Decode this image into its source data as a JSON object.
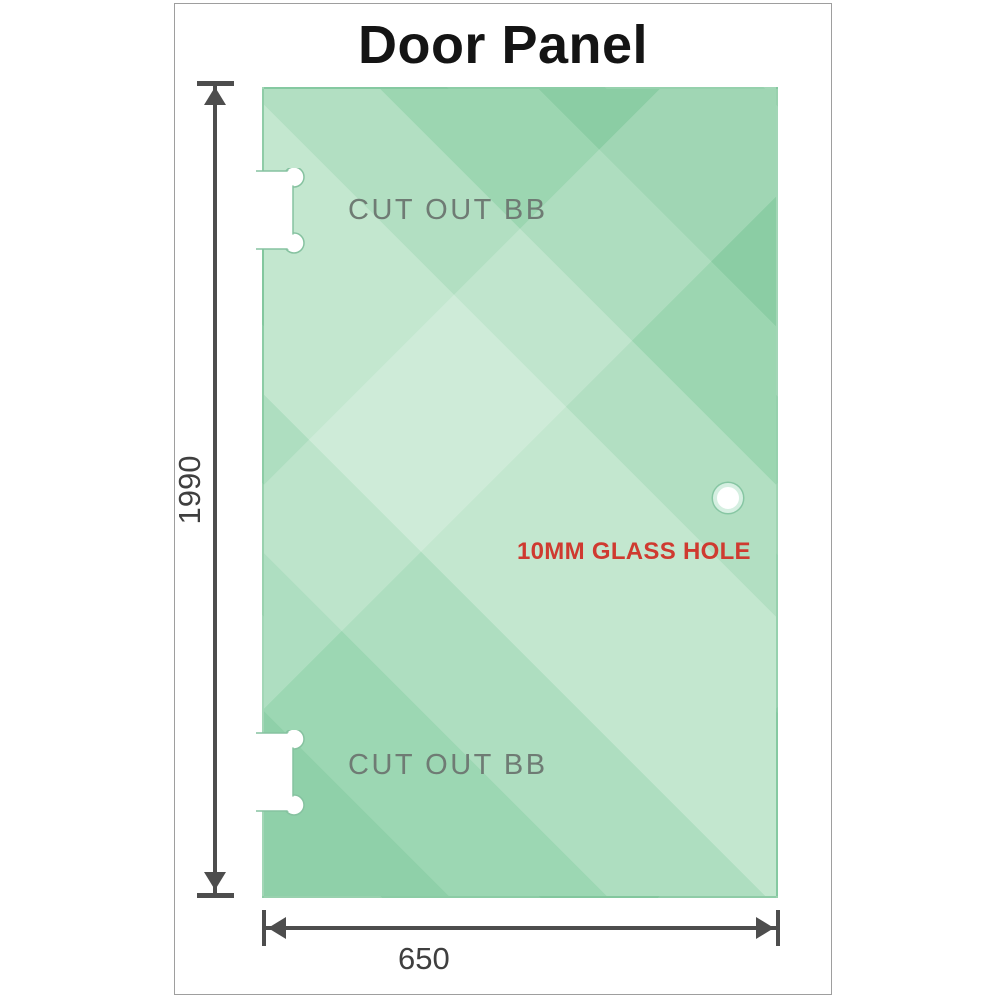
{
  "title": "Door Panel",
  "panel": {
    "cutouts": [
      {
        "label": "CUT OUT BB",
        "position": "top"
      },
      {
        "label": "CUT OUT BB",
        "position": "bottom"
      }
    ],
    "hole_label": "10MM GLASS HOLE"
  },
  "dimensions": {
    "height_label": "1990",
    "width_label": "650"
  },
  "colors": {
    "glass_dark": "#8bcda4",
    "glass_light": "#c3e7cf",
    "hole_label_red": "#cf3a30",
    "cutout_label_gray": "#6f7b74",
    "dimension_gray": "#4d4d4d",
    "card_border": "#9e9e9e"
  }
}
